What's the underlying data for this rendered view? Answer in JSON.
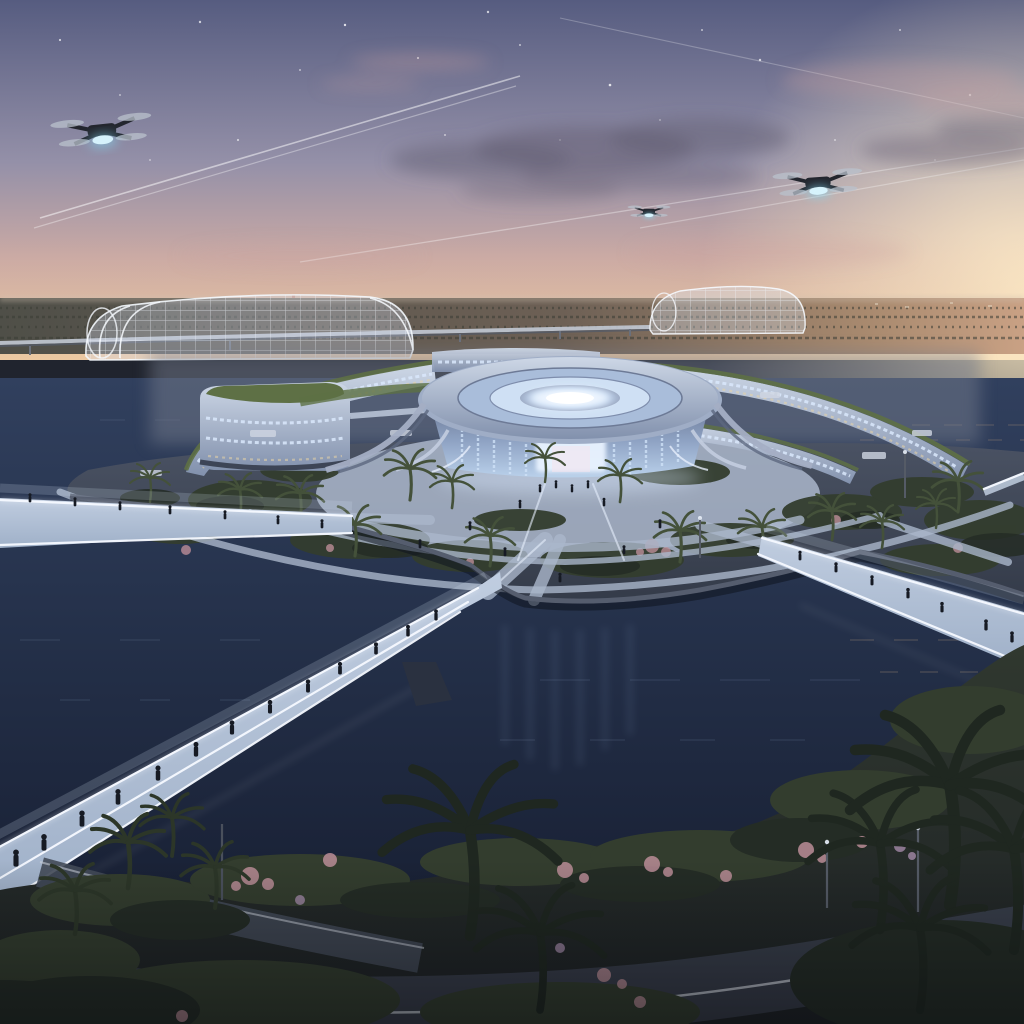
{
  "scene": {
    "title": "Aerial dusk view of a futuristic circular eco-campus island with glowing pedestrian bridges, glass greenhouses and delivery drones",
    "time_of_day": "dusk",
    "setting": "circular island campus surrounded by a dark water moat, outer ring of gardens and palm trees, sunset glow on right horizon",
    "elements": {
      "drones": {
        "count": 3,
        "positions": [
          "upper-left large",
          "upper-right medium",
          "center distant small"
        ],
        "feature": "glowing cyan cargo pod"
      },
      "greenhouses": {
        "count": 2,
        "style": "transparent barrel-vault lattice structures"
      },
      "central_pavilion": "elliptical glass building with concentric glowing roof rings and curved wing canopies",
      "campus_buildings": "curved glass office bands with green planted roofs and lit windows",
      "monorail": "elevated track crossing the horizon",
      "bridges": {
        "count": 4,
        "style": "white LED-edged glass pedestrian bridges with walking people"
      },
      "vegetation": [
        "palm trees",
        "flowering pink shrubs",
        "hedge planters"
      ],
      "sky": [
        "stars",
        "contrails",
        "dark and pink clouds"
      ],
      "road": "curved road with white lane line across the foreground"
    }
  },
  "colors": {
    "sky_top": "#565c80",
    "sky_mid": "#9490a8",
    "sky_pink": "#cbaaa4",
    "sky_horizon": "#ecc9a2",
    "sun_glow": "#ffedc9",
    "cloud_dark": "#5f5a6e",
    "cloud_pink": "#c9a0a0",
    "land_far": "#4f4f48",
    "land_warm": "#a98a6f",
    "glass_frame": "#e9eef6",
    "building_glass_light": "#cdd7e6",
    "building_glass_dark": "#8291ad",
    "window_glow_cool": "#d9e8fb",
    "window_glow_warm": "#e8d3a6",
    "roof_green": "#5e7045",
    "ring_glow": "#eef6ff",
    "ring_metal": "#9fadc6",
    "plaza_light": "#aab6ca",
    "garden_green": "#333d2e",
    "garden_dark": "#242c25",
    "flower_pink": "#bb8d97",
    "flower_violet": "#a389a8",
    "water_light": "#31405e",
    "water_deep": "#161d30",
    "bridge_deck": "#9fb0c8",
    "bridge_led": "#f5f9ff",
    "person_dark": "#161a23",
    "palm_dark": "#1f2720",
    "palm_mid": "#2c3628",
    "palm_light": "#44513a",
    "road_dark": "#3a3f4c",
    "road_line": "#d3d8e1",
    "seawall": "#555d6e",
    "drone_body": "#23262e",
    "drone_glow": "#86dcf5"
  }
}
